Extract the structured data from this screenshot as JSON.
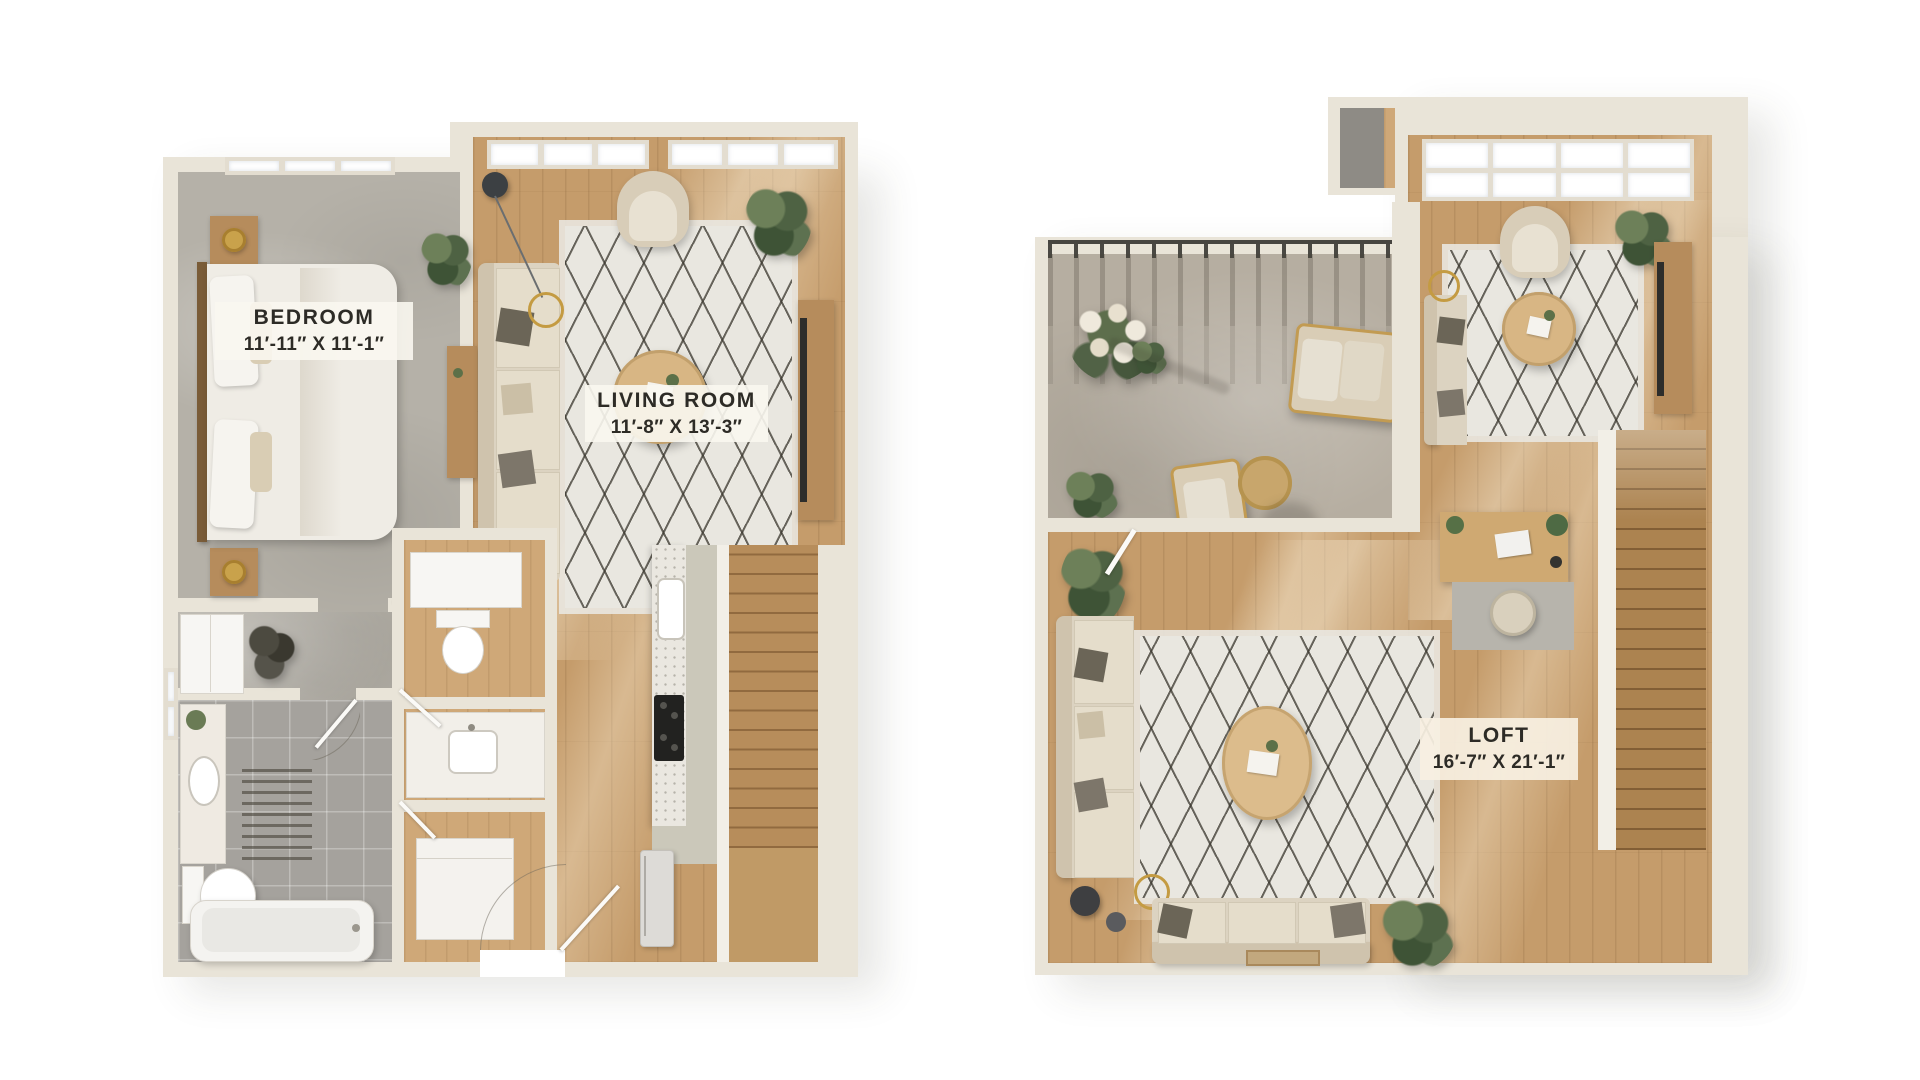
{
  "page": {
    "background_color": "#ffffff",
    "type_label": "two-level apartment floor plans"
  },
  "colors": {
    "wall": "#e9e4d8",
    "wood_floor": "#c59c6b",
    "concrete_floor": "#b5b1a8",
    "bath_tile": "#a5a29d",
    "terrace_floor": "#b6aea1",
    "rug": "#e9e7e0",
    "rug_pattern": "#3a372e",
    "sofa": "#dcd3c1",
    "label_text": "#2d2b26",
    "label_background": "#faf7f0",
    "gold_accent": "#c49b42"
  },
  "plans": {
    "first_floor": {
      "rooms": {
        "bedroom": {
          "name": "BEDROOM",
          "dimensions": "11′-11″ X 11′-1″"
        },
        "living_room": {
          "name": "LIVING ROOM",
          "dimensions": "11′-8″ X 13′-3″"
        }
      }
    },
    "second_floor": {
      "rooms": {
        "loft": {
          "name": "LOFT",
          "dimensions": "16′-7″ X 21′-1″"
        }
      }
    }
  }
}
